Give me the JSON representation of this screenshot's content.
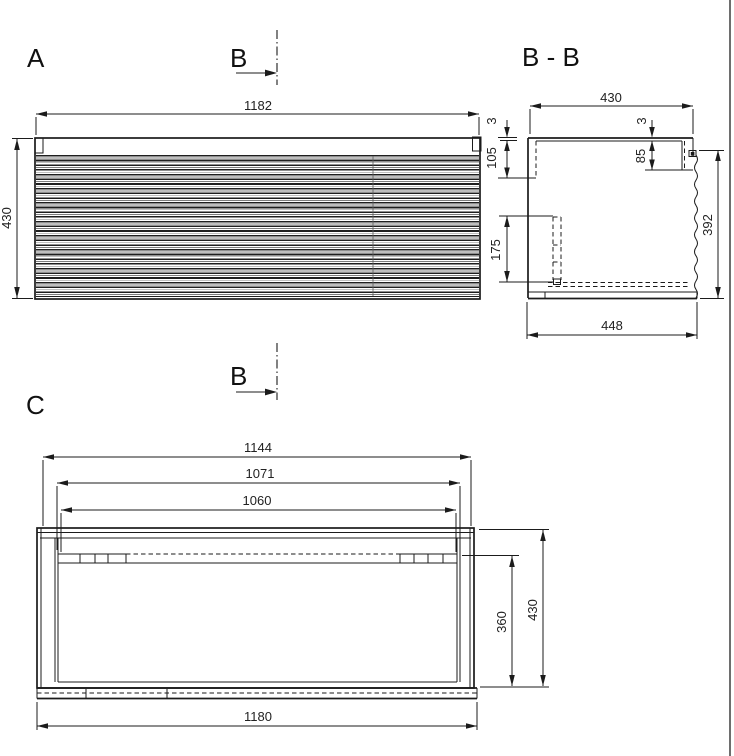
{
  "section_marker": {
    "label": "B"
  },
  "views": {
    "front": {
      "label": "A",
      "dim_width": "1182",
      "dim_height": "430"
    },
    "section": {
      "label": "B - B",
      "dim_width": "430",
      "dim_top_thickness_left": "3",
      "dim_back_rail_height": "105",
      "dim_top_thickness_right": "3",
      "dim_handle_recess": "85",
      "dim_front_panel_height": "392",
      "dim_slide_length": "175",
      "dim_depth": "448"
    },
    "carcass": {
      "label": "C",
      "dim_inner_width": "1144",
      "dim_rail_span": "1071",
      "dim_rail_length": "1060",
      "dim_inner_height": "360",
      "dim_height": "430",
      "dim_width": "1180"
    }
  }
}
